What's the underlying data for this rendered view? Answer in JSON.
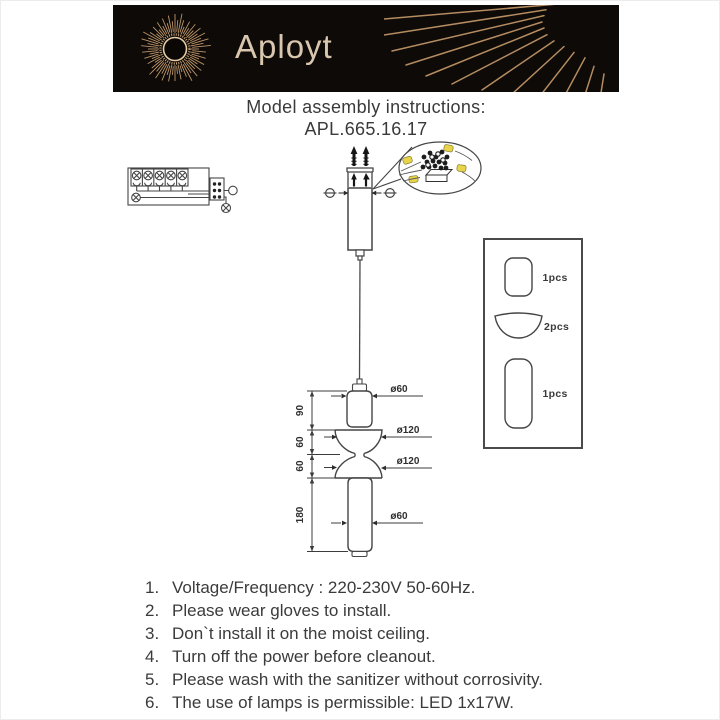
{
  "banner": {
    "brand": "Aployt"
  },
  "title": {
    "line1": "Model assembly instructions:",
    "line2": "APL.665.16.17"
  },
  "drawing": {
    "height_labels": [
      "90",
      "60",
      "60",
      "180"
    ],
    "diameter_labels": [
      "ø60",
      "ø120",
      "ø120",
      "ø60"
    ]
  },
  "parts": [
    {
      "qty": "1pcs"
    },
    {
      "qty": "2pcs"
    },
    {
      "qty": "1pcs"
    }
  ],
  "instructions": [
    {
      "num": "1.",
      "text": "Voltage/Frequency : 220-230V 50-60Hz."
    },
    {
      "num": "2.",
      "text": "Please wear gloves to install."
    },
    {
      "num": "3.",
      "text": "Don`t install it on the moist ceiling."
    },
    {
      "num": "4.",
      "text": "Turn off the power before cleanout."
    },
    {
      "num": "5.",
      "text": "Please wash with the sanitizer without corrosivity."
    },
    {
      "num": "6.",
      "text": "The use of lamps is permissible: LED 1x17W."
    }
  ],
  "colors": {
    "banner_bg": "#0d0a07",
    "brand_gold": "#d9c6ae",
    "ray_gold": "#c79d6f",
    "connector_yellow": "#e8d44a",
    "line": "#454545",
    "text": "#3b3b3b"
  }
}
